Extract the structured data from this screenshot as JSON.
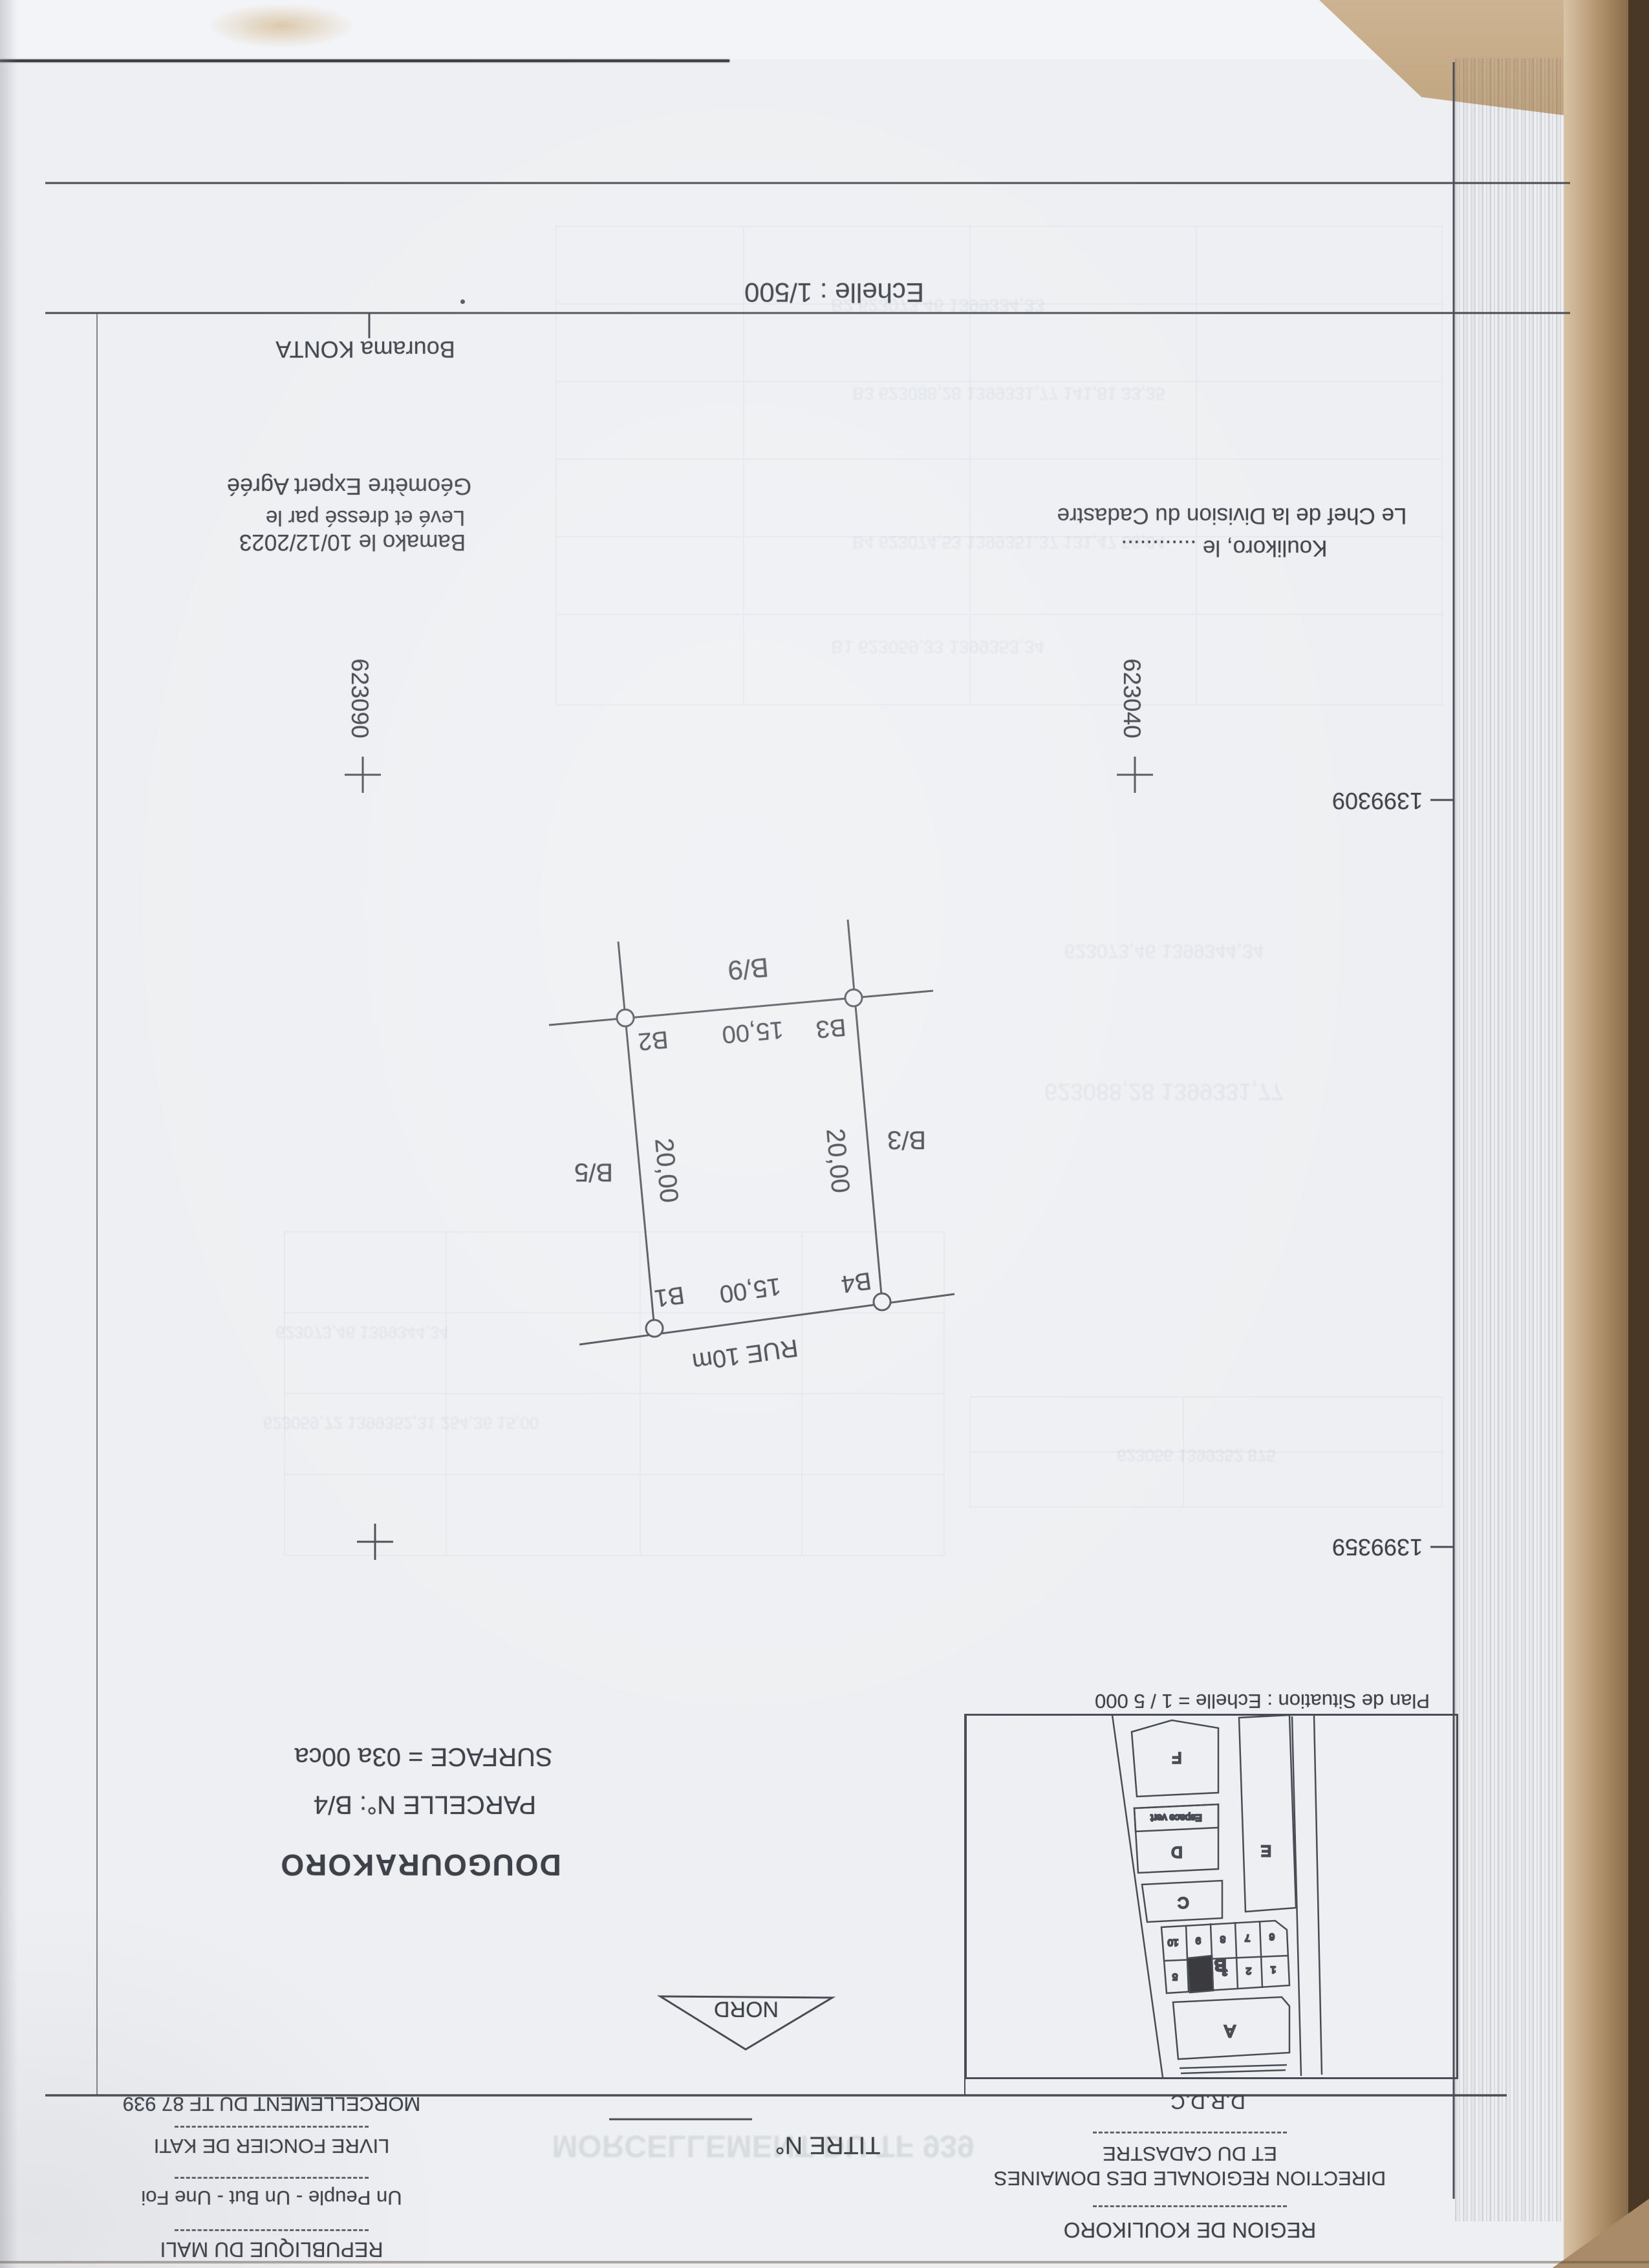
{
  "doc": {
    "scale_label": "Echelle : 1/500",
    "surveyor_name": "Bourama KONTA",
    "surveyor_title": "Géomètre Expert Agréé",
    "leve_line": "Levé et dressé par le",
    "bamako_line": "Bamako le 10/12/2023",
    "cadastre_chief": "Le Chef de la Division du Cadastre",
    "koulikoro_line": "Koulikoro, le ............"
  },
  "grid": {
    "x_left": "623090",
    "x_right": "623040",
    "y_top": "1399309",
    "y_bottom": "1399359"
  },
  "plan": {
    "block_north": "B/9",
    "block_west": "B/5",
    "block_east": "B/3",
    "corner_b1": "B1",
    "corner_b2": "B2",
    "corner_b3": "B3",
    "corner_b4": "B4",
    "dim_top": "15,00",
    "dim_bottom": "15,00",
    "dim_left": "20,00",
    "dim_right": "20,00",
    "street": "RUE 10m"
  },
  "situation": {
    "title": "Plan de Situation : Echelle = 1 / 5 000",
    "caption": "D.R.D.C",
    "espace_vert": "Espace vert",
    "blocks": {
      "a": "A",
      "b": "B",
      "c": "C",
      "d": "D",
      "e": "E",
      "f": "F"
    },
    "lots_row1": [
      "10",
      "9",
      "8",
      "7",
      "6"
    ],
    "lots_row2": [
      "5",
      "3",
      "2",
      "1"
    ]
  },
  "titleblock": {
    "locality": "DOUGOURAKORO",
    "parcel": "PARCELLE N°: B/4",
    "surface": "SURFACE = 03a 00ca",
    "north": "NORD",
    "titre": "TITRE N°"
  },
  "state_block": {
    "morcellement": "MORCELLEMENT DU TF 87 939",
    "livre": "LIVRE FONCIER DE KATI",
    "devise": "Un Peuple - Un But - Une Foi",
    "republique": "REPUBLIQUE DU MALI"
  },
  "admin_block": {
    "drdc": "D.R.D.C",
    "et_du_cadastre": "ET DU CADASTRE",
    "direction": "DIRECTION REGIONALE DES DOMAINES",
    "region": "REGION DE KOULIKORO"
  },
  "colors": {
    "paper": "#edeff2",
    "ink": "#3f4149",
    "line": "#4a4c55",
    "scan_edge_tan": "#b3946e",
    "scan_edge_dark": "#4a3827"
  },
  "ghosts": [
    "B2   623073,46   1399334,33",
    "B3   623088,28   1399331,77   141,81   33,35",
    "B4   623074,53   1399351,37   131,47   56,04",
    "B1   623059,33   1399353,34",
    "623073,46   1399344,34",
    "623088,28   1399331,77",
    "623073,46   1399344,34",
    "623059,72   1399352,31   254,36   15,00",
    "MORCELLEMENT DU TF 939",
    "623056   1399352   875"
  ]
}
